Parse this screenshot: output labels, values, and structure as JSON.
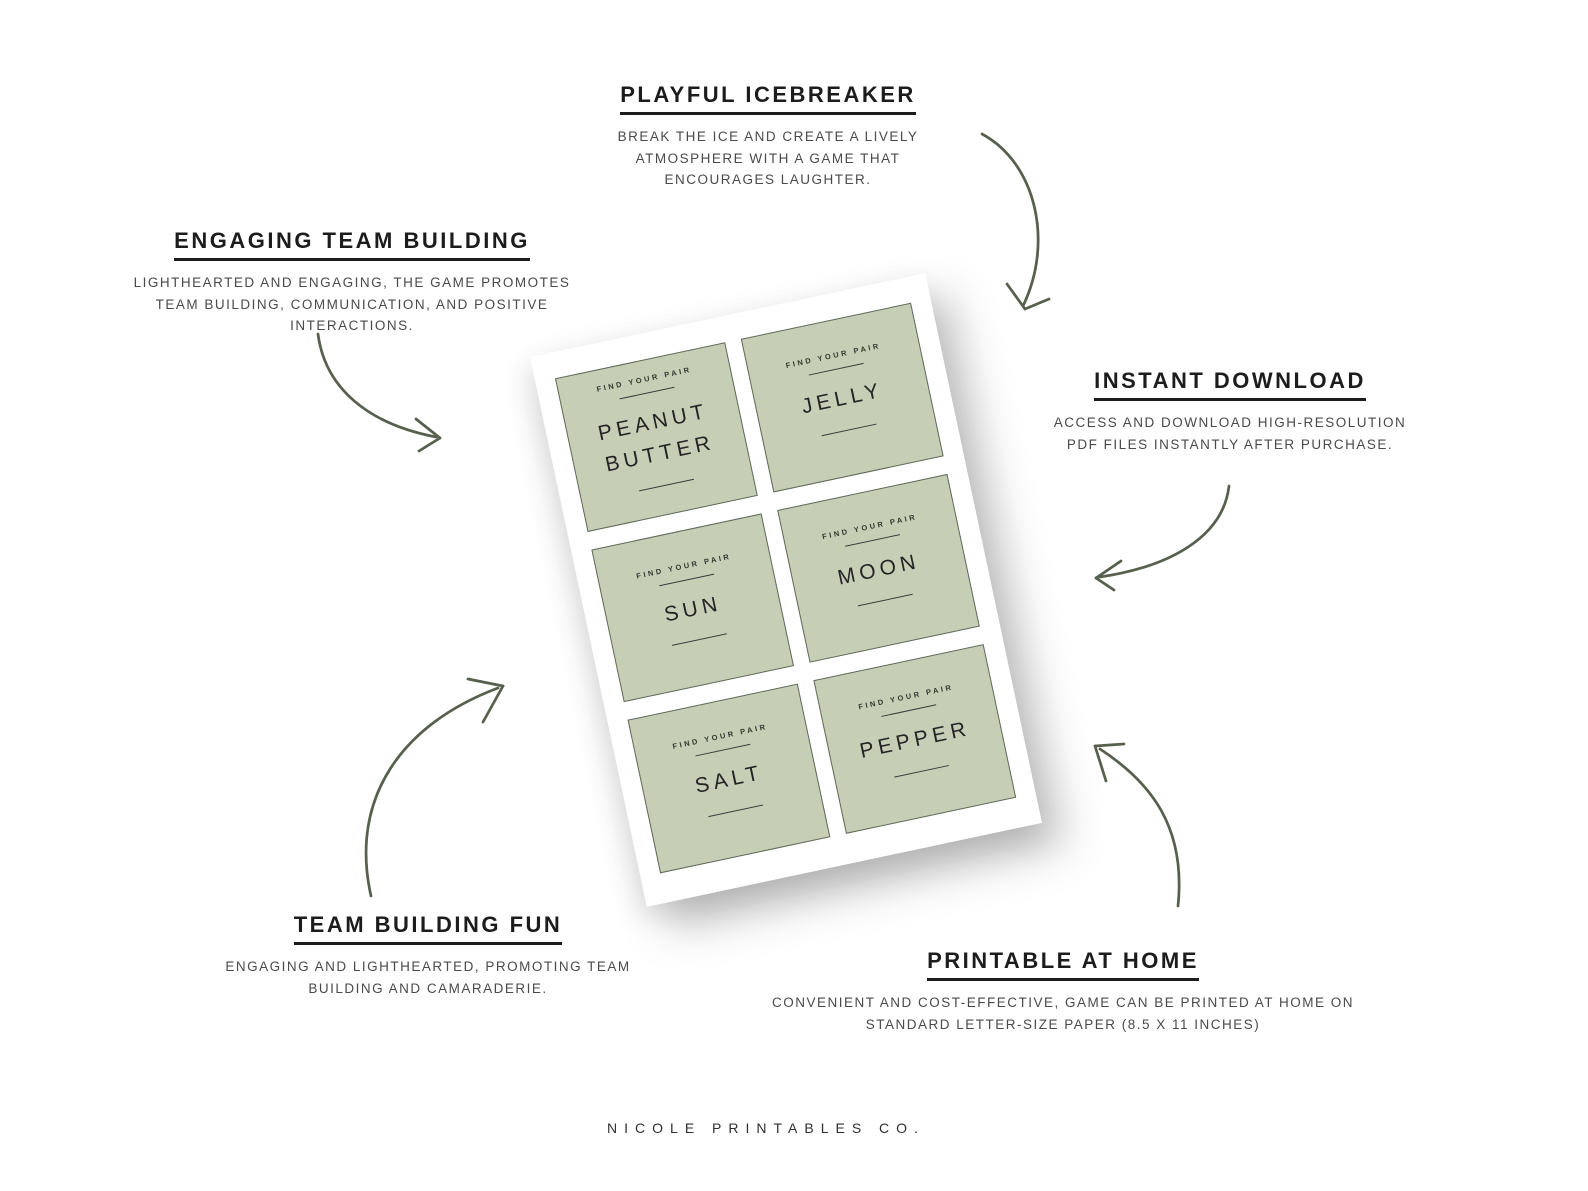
{
  "brand": {
    "name": "NICOLE PRINTABLES CO."
  },
  "features": {
    "playful_icebreaker": {
      "title": "PLAYFUL ICEBREAKER",
      "body": "BREAK THE ICE AND CREATE A LIVELY ATMOSPHERE WITH A GAME THAT ENCOURAGES LAUGHTER."
    },
    "engaging_team_building": {
      "title": "ENGAGING TEAM BUILDING",
      "body": "LIGHTHEARTED AND ENGAGING, THE GAME PROMOTES TEAM BUILDING, COMMUNICATION, AND POSITIVE INTERACTIONS."
    },
    "instant_download": {
      "title": "INSTANT DOWNLOAD",
      "body": "ACCESS AND DOWNLOAD HIGH-RESOLUTION PDF FILES INSTANTLY AFTER PURCHASE."
    },
    "team_building_fun": {
      "title": "TEAM BUILDING FUN",
      "body": "ENGAGING AND LIGHTHEARTED, PROMOTING TEAM BUILDING AND CAMARADERIE."
    },
    "printable_at_home": {
      "title": "PRINTABLE AT HOME",
      "body": "CONVENIENT AND COST-EFFECTIVE, GAME CAN BE PRINTED AT HOME ON STANDARD LETTER-SIZE PAPER (8.5 X 11 INCHES)"
    }
  },
  "sheet": {
    "card_label": "FIND YOUR PAIR",
    "cards": [
      "PEANUT BUTTER",
      "JELLY",
      "SUN",
      "MOON",
      "SALT",
      "PEPPER"
    ]
  },
  "colors": {
    "background": "#ffffff",
    "card_green": "#c6cfb6",
    "card_border": "#60695a",
    "arrow": "#57604d",
    "heading_text": "#1c1c1c",
    "body_text": "#4a4a4a"
  }
}
